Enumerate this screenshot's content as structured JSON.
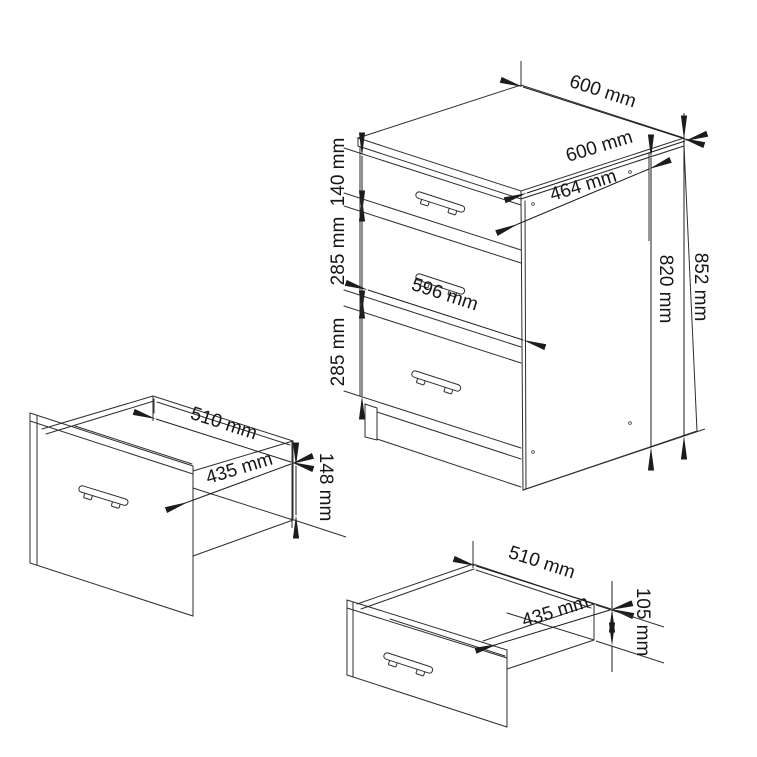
{
  "figure": {
    "kind": "furniture-dimension-drawing",
    "background_color": "#ffffff",
    "ink_color": "#2e2e2e",
    "cabinet": {
      "dim_top_back_edge": "600 mm",
      "dim_top_front_edge": "600 mm",
      "dim_side_depth": "464 mm",
      "dim_total_height": "852 mm",
      "dim_carcass_height": "820 mm",
      "dim_drawer1_height": "140 mm",
      "dim_drawer2_height": "285 mm",
      "dim_drawer3_height": "285 mm",
      "dim_front_width": "596 mm"
    },
    "drawer_detail_left": {
      "dim_width": "510 mm",
      "dim_depth": "435 mm",
      "dim_height": "148 mm"
    },
    "drawer_detail_bottom": {
      "dim_width": "510 mm",
      "dim_depth": "435 mm",
      "dim_height": "105 mm"
    }
  }
}
